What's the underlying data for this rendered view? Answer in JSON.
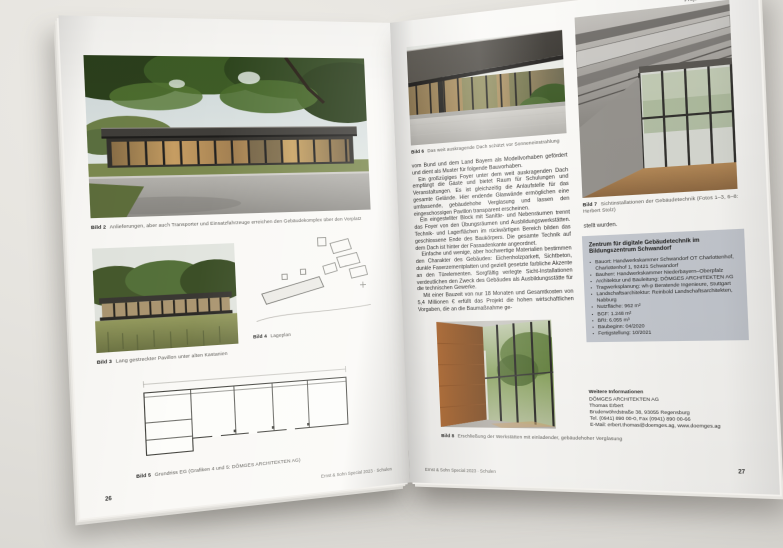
{
  "header": {
    "right_label": "Projektberichte"
  },
  "footer": {
    "imprint": "Ernst & Sohn Special 2023 · Schulen",
    "page_left_number": "26",
    "page_right_number": "27"
  },
  "page_left": {
    "captions": {
      "bild2": {
        "label": "Bild 2",
        "text": "Anlieferungen, aber auch Transporter und Einsatzfahrzeuge erreichen den Gebäudekomplex über den Vorplatz"
      },
      "bild3": {
        "label": "Bild 3",
        "text": "Lang gestreckter Pavillon unter alten Kastanien"
      },
      "bild4": {
        "label": "Bild 4",
        "text": "Lageplan"
      },
      "bild5": {
        "label": "Bild 5",
        "text": "Grundriss EG (Grafiken 4 und 5: DÖMGES ARCHITEKTEN AG)"
      }
    },
    "illustrations": {
      "photo_top": "building-exterior-under-tree-canopy",
      "photo_mid": "pavilion-behind-meadow",
      "siteplan": "site-plan-line-drawing",
      "floorplan": "ground-floor-plan-drawing"
    }
  },
  "page_right": {
    "captions": {
      "bild6": {
        "label": "Bild 6",
        "text": "Das weit auskragende Dach schützt vor Sonneneinstrahlung"
      },
      "bild7": {
        "label": "Bild 7",
        "text": "Sichtinstallationen der Gebäudetechnik (Fotos 1–3, 6–8: Herbert Stolz)"
      },
      "bild8": {
        "label": "Bild 8",
        "text": "Erschließung der Werkstätten mit einladender, gebäudehoher Verglasung"
      }
    },
    "body": [
      "vom Bund und dem Land Bayern als Modellvorhaben gefördert und dient als Muster für folgende Bauvorhaben.",
      "Ein großzügiges Foyer unter dem weit auskragenden Dach empfängt die Gäste und bietet Raum für Schulungen und Veranstaltungen. Es ist gleichzeitig die Anlaufstelle für das gesamte Gelände. Hier endende Glaswände ermöglichen eine umfassende, gebäudehohe Verglasung und lassen den eingeschossigen Pavillon transparent erscheinen.",
      "Ein eingestellter Block mit Sanitär- und Nebenräumen trennt das Foyer von den Übungsräumen und Ausbildungswerkstätten. Technik- und Lagerflächen im rückwärtigen Bereich bilden das geschlossene Ende des Baukörpers. Die gesamte Technik auf dem Dach ist hinter der Fassadenkante angeordnet.",
      "Einfache und wenige, aber hochwertige Materialien bestimmen den Charakter des Gebäudes: Eichenholzparkett, Sichtbeton, dunkle Faserzementplatten und gezielt gesetzte farbliche Akzente an den Türelementen. Sorgfältig verlegte Sicht-Installationen verdeutlichen den Zweck des Gebäudes als Ausbildungsstätte für die technischen Gewerke.",
      "Mit einer Bauzeit von nur 18 Monaten und Gesamtkosten von 5,4 Millionen € erfüllt das Projekt die hohen wirtschaftlichen Vorgaben, die an die Baumaßnahme ge-"
    ],
    "continuation": "stellt wurden.",
    "infobox": {
      "title": "Zentrum für digitale Gebäudetechnik im Bildungszentrum Schwandorf",
      "items": [
        "Bauort: Handwerkskammer Schwandorf OT Charlottenhof, Charlottenhof 1, 92421 Schwandorf",
        "Bauherr: Handwerkskammer Niederbayern–Oberpfalz",
        "Architektur und Bauleitung: DÖMGES ARCHITEKTEN AG",
        "Tragwerksplanung: wh-p Beratende Ingenieure, Stuttgart",
        "Landschaftsarchitektur: Reinbold Landschaftsarchitekten, Nabburg",
        "Nutzfläche: 962 m²",
        "BGF: 1.248 m²",
        "BRI: 6.055 m³",
        "Baubeginn: 04/2020",
        "Fertigstellung: 10/2021"
      ]
    },
    "contact": {
      "heading": "Weitere Informationen",
      "lines": [
        "DÖMGES ARCHITEKTEN AG",
        "Thomas Erbert",
        "Bruderwöhrdstraße 38, 93055 Regensburg",
        "Tel. (0941) 890 00-0, Fax (0941) 890 00-66",
        "E-Mail: erbert.thomas@doemges.ag, www.doemges.ag"
      ]
    },
    "illustrations": {
      "photo_top": "cantilevered-roof-exterior",
      "photo_tall": "exposed-ceiling-installations-interior",
      "photo_bottom": "glazed-corridor-with-wood-wall"
    }
  },
  "colors": {
    "desk": "#e3e1dc",
    "paper": "#faf9f6",
    "infobox_bg": "#c6cad1",
    "foliage_green": "#3e5c26",
    "wood_accent": "#b06c33",
    "roof_dark": "#37342f"
  }
}
